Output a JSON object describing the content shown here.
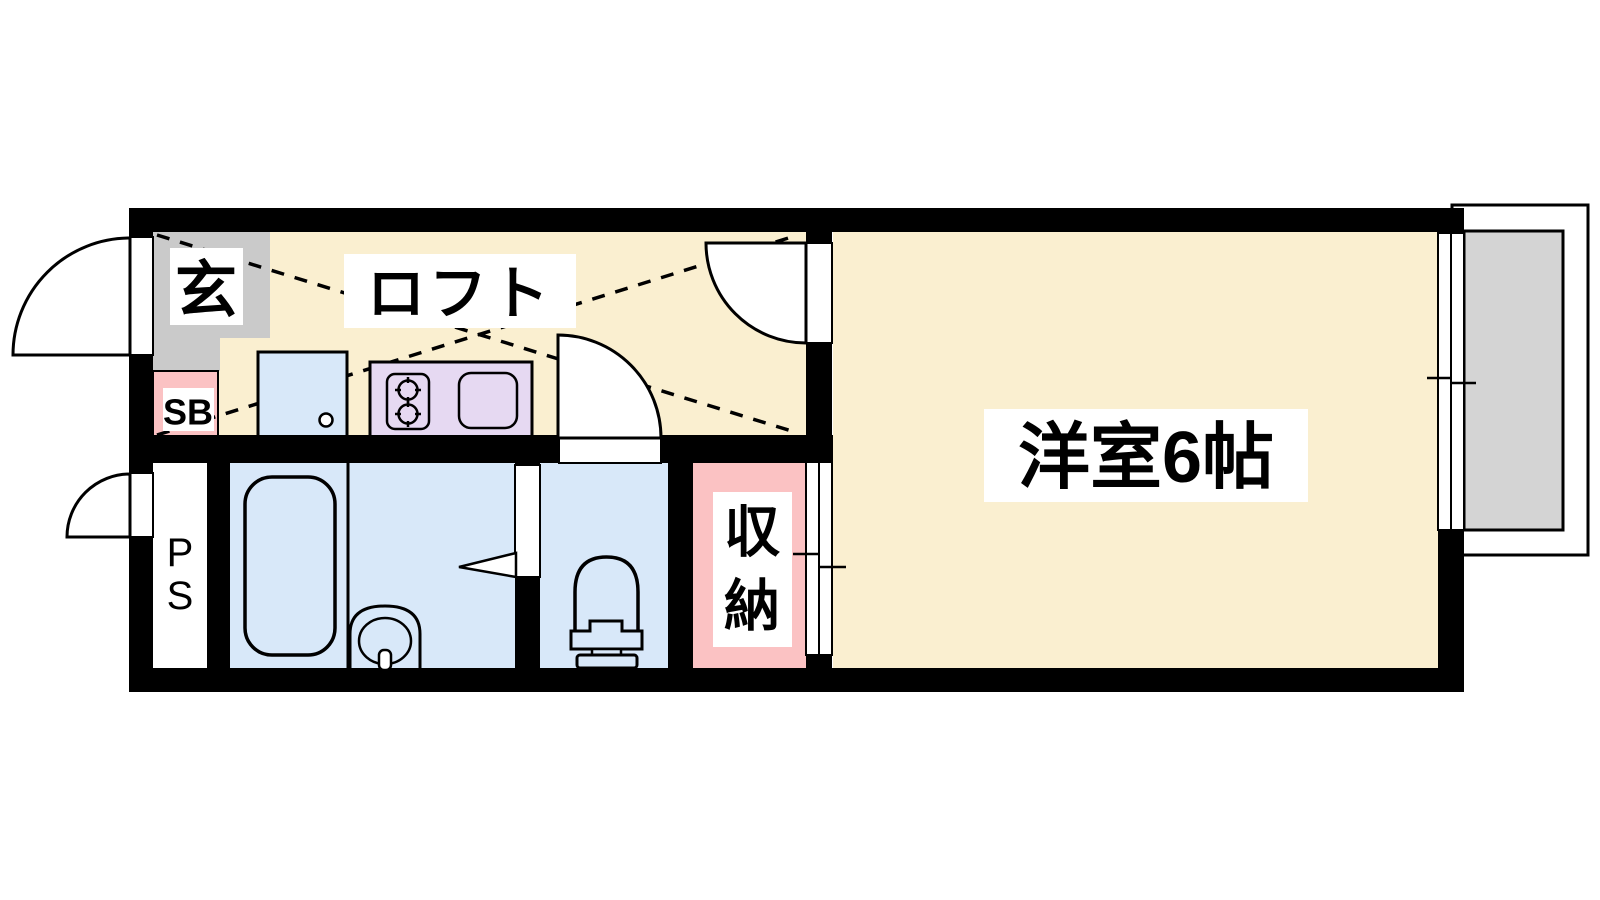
{
  "meta": {
    "kind": "floor-plan"
  },
  "colors": {
    "wall": "#000000",
    "line": "#000000",
    "floor_cream": "#FAEFD0",
    "genkan_gray": "#CACACA",
    "pink": "#FBC2C3",
    "wet_blue": "#D8E8F9",
    "kitchen_purple": "#E6D9F2",
    "balcony_gray": "#D4D4D4",
    "label_bg": "#FFFFFF",
    "door_white": "#FFFFFF"
  },
  "labels": {
    "entrance": "玄",
    "loft": "ロフト",
    "shoe_box": "SB",
    "pipe_space_chars": [
      "P",
      "S"
    ],
    "storage_chars": [
      "収",
      "納"
    ],
    "western_room": "洋室6帖"
  }
}
